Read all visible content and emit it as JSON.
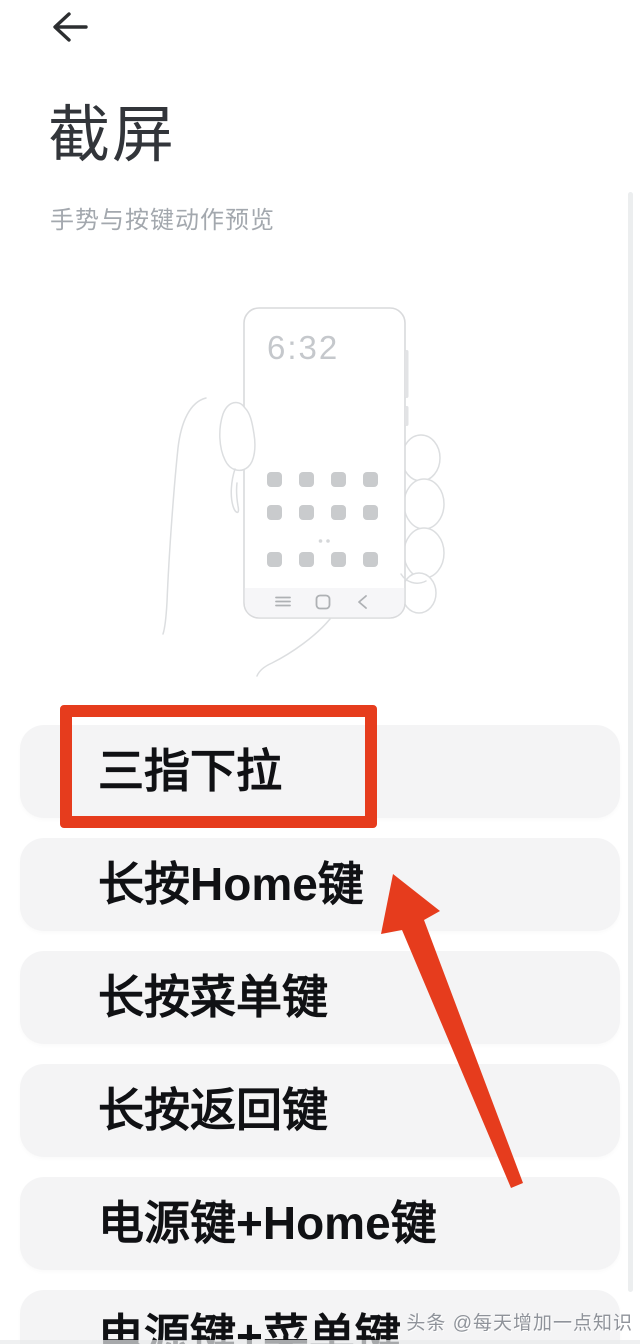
{
  "header": {
    "title": "截屏",
    "subtitle": "手势与按键动作预览"
  },
  "illustration": {
    "clock": "6:32"
  },
  "options": [
    {
      "label": "三指下拉",
      "highlighted": true
    },
    {
      "label": "长按Home键",
      "highlighted": false
    },
    {
      "label": "长按菜单键",
      "highlighted": false
    },
    {
      "label": "长按返回键",
      "highlighted": false
    },
    {
      "label": "电源键+Home键",
      "highlighted": false
    },
    {
      "label": "电源键+菜单键",
      "highlighted": false
    }
  ],
  "annotation": {
    "highlight_color": "#e63c1d"
  },
  "watermark": {
    "text": "头条 @每天增加一点知识"
  }
}
